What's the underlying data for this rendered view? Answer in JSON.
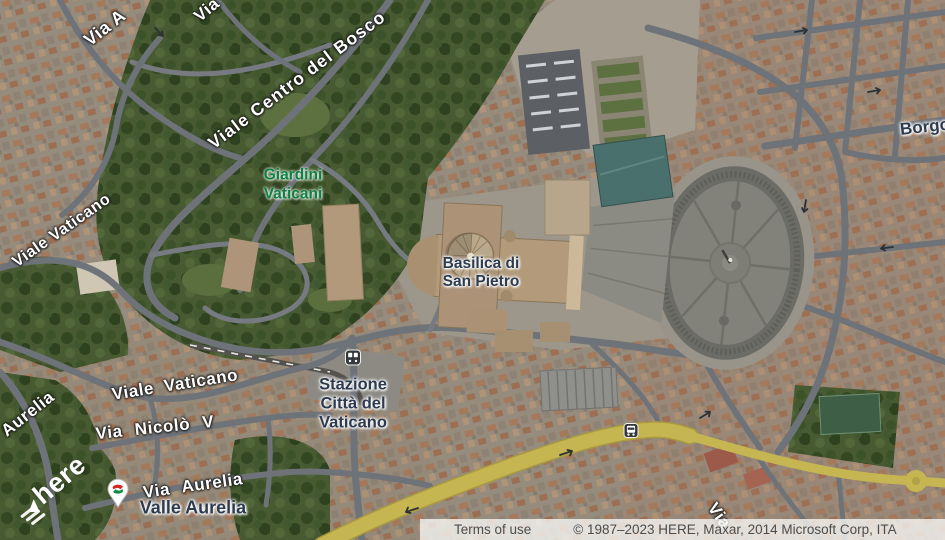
{
  "map": {
    "provider_logo": "here",
    "labels": {
      "via_a_top": "Via A",
      "via_top": "Via",
      "viale_centro_del_bosco": "Viale Centro del Bosco",
      "giardini_line1": "Giardini",
      "giardini_line2": "Vaticani",
      "viale_vaticano_upper": "Viale Vaticano",
      "basilica_line1": "Basilica di",
      "basilica_line2": "San Pietro",
      "borgo": "Borgo",
      "stazione_line1": "Stazione",
      "stazione_line2": "Città del",
      "stazione_line3": "Vaticano",
      "viale_vaticano_lower": "Viale Vaticano",
      "via_nicolo_v": "Via Nicolò V",
      "aurelia": "Aurelia",
      "via_aurelia": "Via Aurelia",
      "valle_aurelia": "Valle Aurelia",
      "via_bottom": "Via"
    },
    "icons": [
      "train-station-icon",
      "bus-stop-icon",
      "rail-transit-pin-icon",
      "here-logo-triangle-icon"
    ],
    "colors": {
      "place_label": "#2c3b50",
      "park_label": "#0f7f45",
      "road_label": "#ffffff",
      "highway": "#c6b652",
      "park_green": "#475a31",
      "road_gray": "#6e7379",
      "attribution_text": "#4c4c4c"
    }
  },
  "attribution": {
    "terms_label": "Terms of use",
    "copyright": "© 1987–2023 HERE, Maxar, 2014 Microsoft Corp, ITA"
  }
}
